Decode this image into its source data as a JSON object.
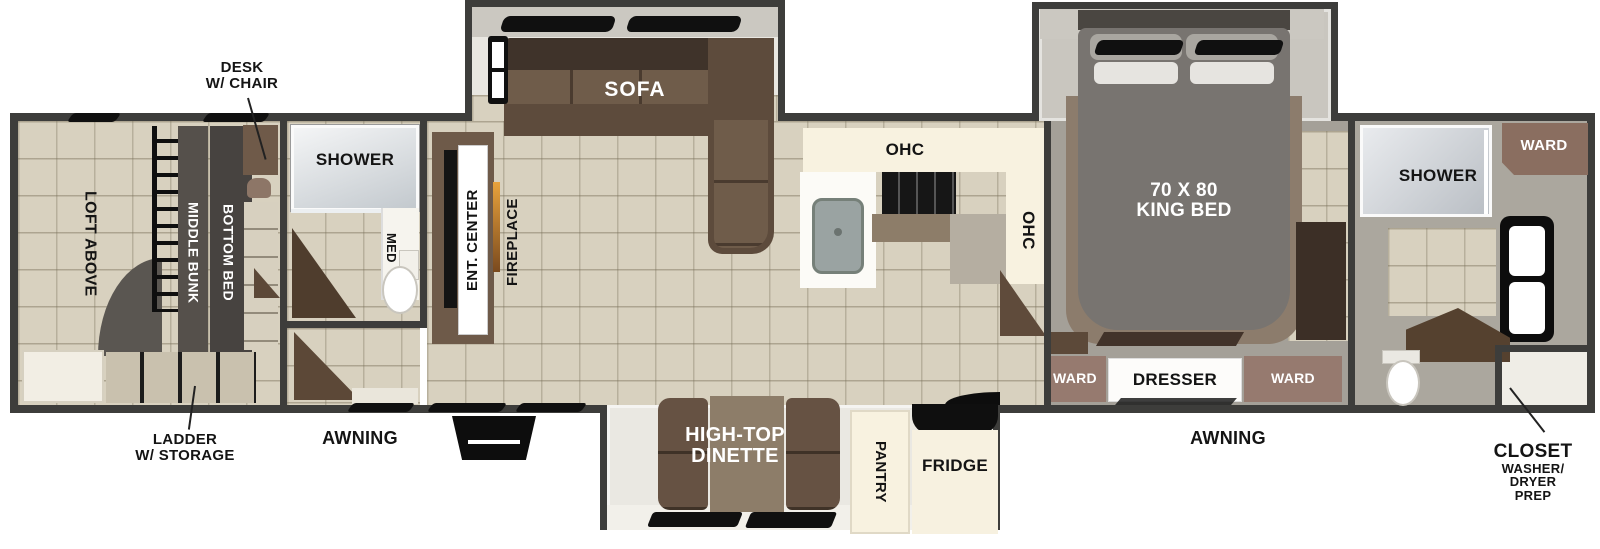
{
  "colors": {
    "wall": "#3d3d3b",
    "floor_tile": "#d8d1bf",
    "floor_gray": "#a4a098",
    "cabinet_cream": "#f8f2e0",
    "sofa_brown": "#5d4b3c",
    "ward_brown": "#967a6f",
    "bed_gray": "#787470",
    "callout_text": "#111111"
  },
  "plan": {
    "bunk_room": {
      "loft_above": "LOFT ABOVE",
      "middle_bunk": "MIDDLE BUNK",
      "bottom_bed": "BOTTOM BED"
    },
    "mid_bath": {
      "shower": "SHOWER",
      "med": "MED"
    },
    "living": {
      "ent_center": "ENT. CENTER",
      "fireplace": "FIREPLACE",
      "sofa": "SOFA"
    },
    "kitchen": {
      "ohc_top": "OHC",
      "ohc_side": "OHC"
    },
    "dinette": {
      "line1": "HIGH-TOP",
      "line2": "DINETTE",
      "pantry": "PANTRY",
      "fridge": "FRIDGE"
    },
    "bedroom": {
      "bed_size": "70 X 80",
      "bed_type": "KING BED",
      "ward_left": "WARD",
      "dresser": "DRESSER",
      "ward_right": "WARD"
    },
    "rear_bath": {
      "shower": "SHOWER",
      "ward": "WARD"
    },
    "callouts": {
      "desk_line1": "DESK",
      "desk_line2": "W/ CHAIR",
      "ladder_line1": "LADDER",
      "ladder_line2": "W/ STORAGE",
      "awning_left": "AWNING",
      "awning_right": "AWNING",
      "closet_title": "CLOSET",
      "closet_line1": "WASHER/",
      "closet_line2": "DRYER",
      "closet_line3": "PREP"
    }
  }
}
